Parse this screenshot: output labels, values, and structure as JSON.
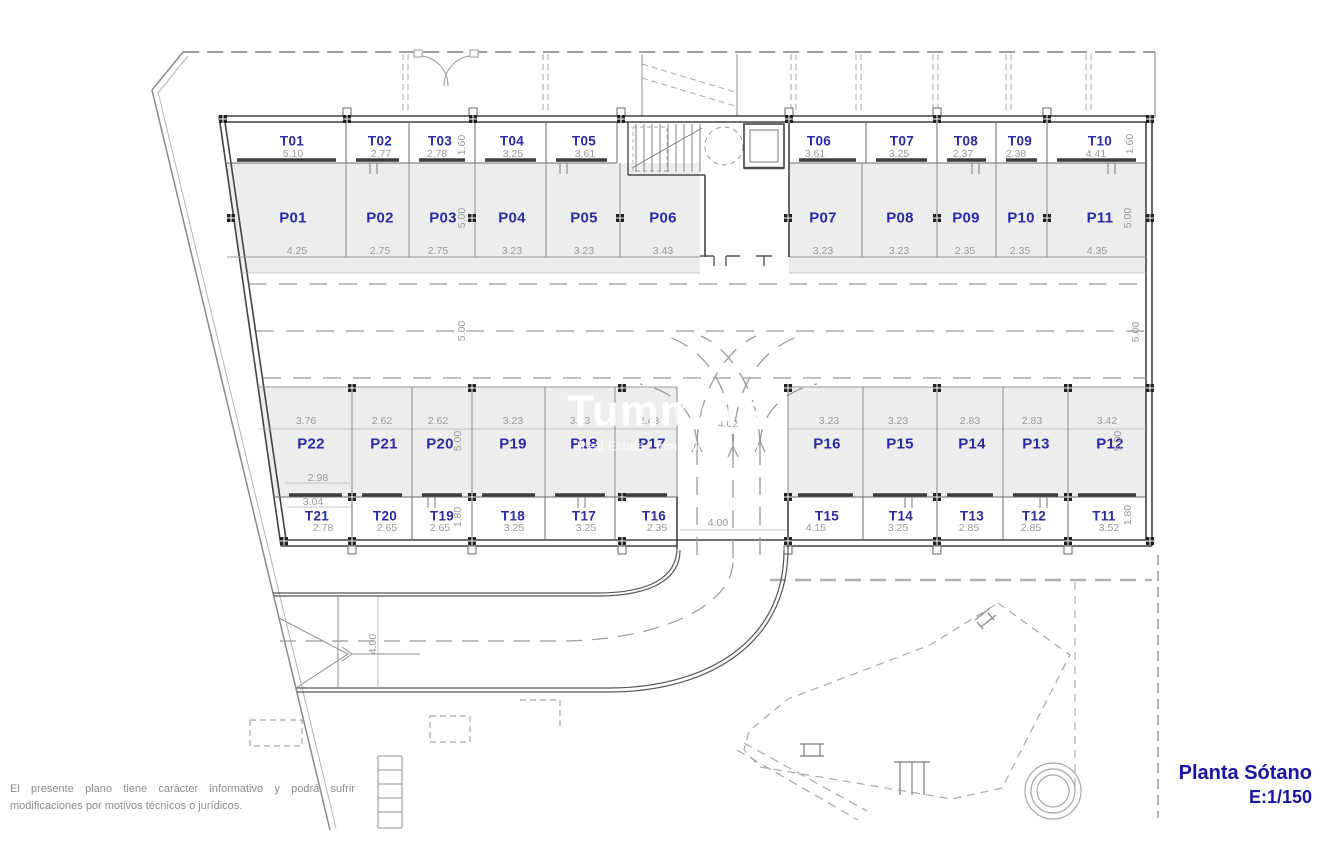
{
  "title_block": {
    "title": "Planta Sótano",
    "scale": "E:1/150"
  },
  "disclaimer": {
    "line1": "El presente plano tiene carácter informativo y podrá sufrir",
    "line2": "modificaciones por motivos técnicos o jurídicos."
  },
  "watermark": {
    "brand": "Tummers",
    "tagline": "Real Estate - Inmobiliaria - Imm"
  },
  "colors": {
    "label_blue": "#2b2ba3",
    "title_blue": "#1813a4",
    "dim_gray": "#9a9a9a",
    "stall_fill": "#ededed",
    "wall_dark": "#424242"
  },
  "storage_top": [
    {
      "id": "T01",
      "dim": "5.10"
    },
    {
      "id": "T02",
      "dim": "2.77"
    },
    {
      "id": "T03",
      "dim": "2.78"
    },
    {
      "id": "T04",
      "dim": "3.25"
    },
    {
      "id": "T05",
      "dim": "3.61"
    },
    {
      "id": "T06",
      "dim": "3.61"
    },
    {
      "id": "T07",
      "dim": "3.25"
    },
    {
      "id": "T08",
      "dim": "2.37"
    },
    {
      "id": "T09",
      "dim": "2.38"
    },
    {
      "id": "T10",
      "dim": "4.41"
    }
  ],
  "parking_top": [
    {
      "id": "P01",
      "dim": "4.25"
    },
    {
      "id": "P02",
      "dim": "2.75"
    },
    {
      "id": "P03",
      "dim": "2.75"
    },
    {
      "id": "P04",
      "dim": "3.23"
    },
    {
      "id": "P05",
      "dim": "3.23"
    },
    {
      "id": "P06",
      "dim": "3.43"
    },
    {
      "id": "P07",
      "dim": "3.23"
    },
    {
      "id": "P08",
      "dim": "3.23"
    },
    {
      "id": "P09",
      "dim": "2.35"
    },
    {
      "id": "P10",
      "dim": "2.35"
    },
    {
      "id": "P11",
      "dim": "4.35"
    }
  ],
  "parking_bottom": [
    {
      "id": "P22",
      "dim": "3.76"
    },
    {
      "id": "P21",
      "dim": "2.62"
    },
    {
      "id": "P20",
      "dim": "2.62"
    },
    {
      "id": "P19",
      "dim": "3.23"
    },
    {
      "id": "P18",
      "dim": "3.23"
    },
    {
      "id": "P17",
      "dim": "2.43"
    },
    {
      "id": "P16",
      "dim": "3.23"
    },
    {
      "id": "P15",
      "dim": "3.23"
    },
    {
      "id": "P14",
      "dim": "2.83"
    },
    {
      "id": "P13",
      "dim": "2.83"
    },
    {
      "id": "P12",
      "dim": "3.42"
    }
  ],
  "storage_bottom": [
    {
      "id": "T21",
      "dim": "2.78"
    },
    {
      "id": "T20",
      "dim": "2.65"
    },
    {
      "id": "T19",
      "dim": "2.65"
    },
    {
      "id": "T18",
      "dim": "3.25"
    },
    {
      "id": "T17",
      "dim": "3.25"
    },
    {
      "id": "T16",
      "dim": "2.35"
    },
    {
      "id": "T15",
      "dim": "4.15"
    },
    {
      "id": "T14",
      "dim": "3.25"
    },
    {
      "id": "T13",
      "dim": "2.85"
    },
    {
      "id": "T12",
      "dim": "2.85"
    },
    {
      "id": "T11",
      "dim": "3.52"
    }
  ],
  "extra_dims": {
    "h160_left": "1.60",
    "h160_right": "1.60",
    "d500_bay_tl": "5.00",
    "d500_bay_tr": "5.00",
    "d500_aisle_l": "5.00",
    "d500_aisle_r": "5.00",
    "d500_bay_bl": "5.00",
    "d500_bay_br": "5.00",
    "h180_left": "1.80",
    "h180_right": "1.80",
    "entry_400": "4.00",
    "p22_front": "2.98",
    "t21_width": "3.04",
    "ramp_width": "4.02",
    "ramp_bottom": "4.00"
  }
}
